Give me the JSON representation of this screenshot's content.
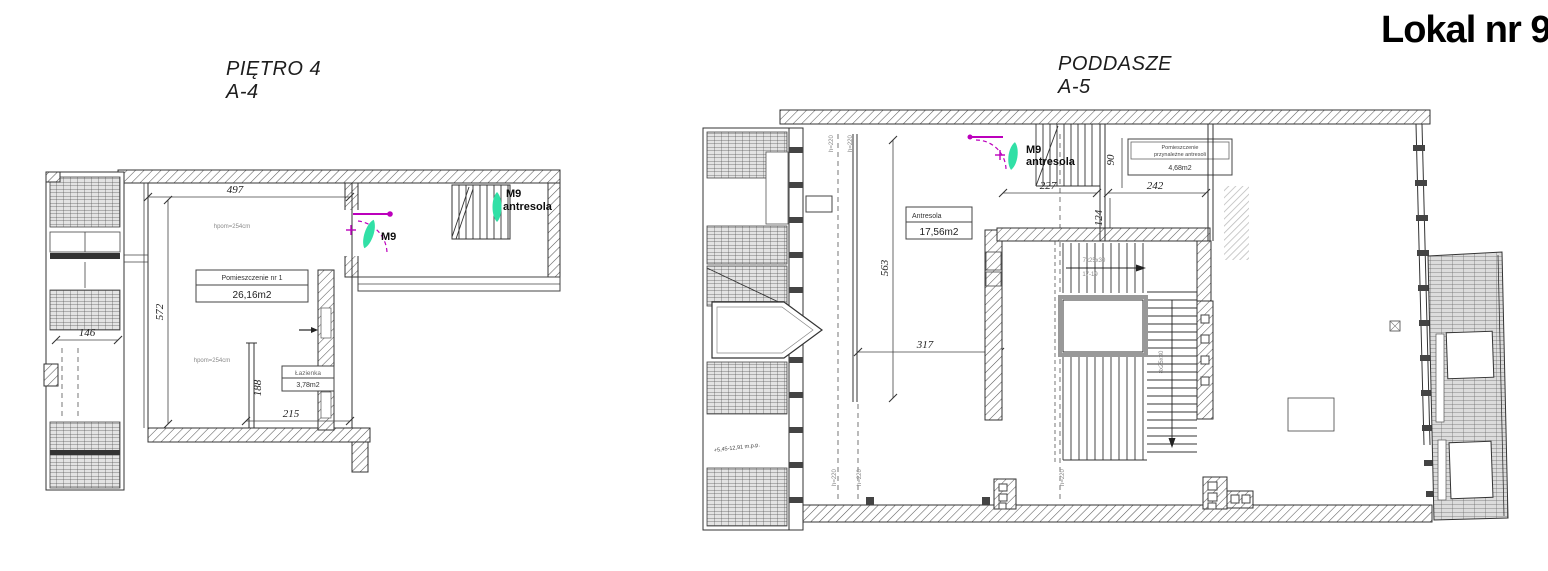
{
  "sheet": {
    "title": "Lokal nr 9"
  },
  "colors": {
    "teal": "#31E0A6",
    "magenta": "#BC00BC"
  },
  "left_plan": {
    "title": "PIĘTRO 4",
    "code": "A-4",
    "dim_width": "497",
    "dim_height": "572",
    "dim_146": "146",
    "dim_188": "188",
    "dim_215": "215",
    "height_note_1": "hpom=254cm",
    "height_note_2": "hpom=254cm",
    "room_name": "Pomieszczenie nr 1",
    "room_area": "26,16m2",
    "bath_name": "Łazienka",
    "bath_area": "3,78m2",
    "m9_label": "M9",
    "m9_antresola_line1": "M9",
    "m9_antresola_line2": "antresola"
  },
  "right_plan": {
    "title": "PODDASZE",
    "code": "A-5",
    "dim_563": "563",
    "dim_317": "317",
    "dim_227": "227",
    "dim_242": "242",
    "dim_90": "90",
    "dim_124": "124",
    "antresola_name": "Antresola",
    "antresola_area": "17,56m2",
    "pom_name_line1": "Pomieszczenie",
    "pom_name_line2": "przynależne antresoli",
    "pom_area": "4,68m2",
    "m9_line1": "M9",
    "m9_line2": "antresola",
    "stair_note_top1": "7x25x30",
    "stair_note_top2": "17-19",
    "stair_note_right": "8x25x30",
    "level_note": "+5,45-12,91 m.p.p.",
    "height_line_note": "h=220"
  }
}
